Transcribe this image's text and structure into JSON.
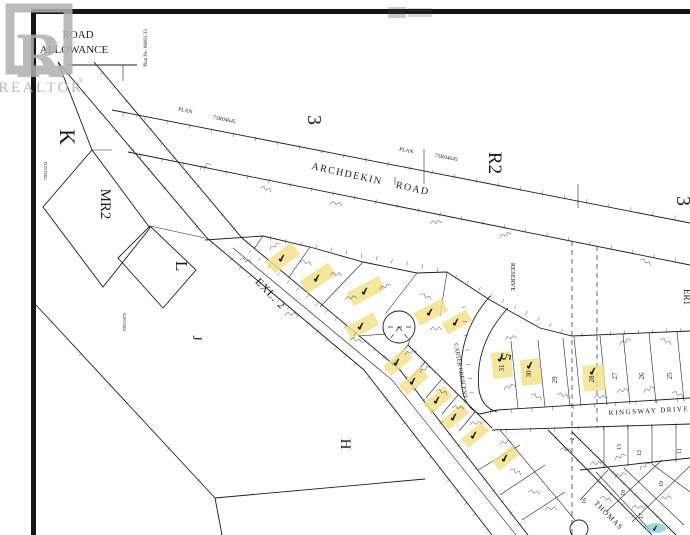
{
  "watermark": {
    "brand": "REALTOR",
    "registered": "®",
    "logo_letter": "R"
  },
  "colors": {
    "ink": "#1c1c1c",
    "highlight_yellow": "#f2e18a",
    "teal_marker": "#79cfcd",
    "watermark_gray": "#acacac",
    "paper": "#ffffff"
  },
  "annotations": {
    "mark_glyph": "✔",
    "marked_lot_count": 15,
    "teal_marked_count": 1
  },
  "labels": [
    {
      "id": "road-allowance-line1",
      "text": "ROAD",
      "x": 78,
      "y": 38,
      "rot": 0,
      "size": 11
    },
    {
      "id": "road-allowance-line2",
      "text": "ALLOWANCE",
      "x": 74,
      "y": 53,
      "rot": 0,
      "size": 11
    },
    {
      "id": "plan-number-vertical",
      "text": "Plan No. 86603 33",
      "x": 147,
      "y": 48,
      "rot": -90,
      "size": 5
    },
    {
      "id": "plan-label-1",
      "text": "PLAN",
      "x": 185,
      "y": 112,
      "rot": 12,
      "size": 5.5
    },
    {
      "id": "plan-number-1",
      "text": "75R04645",
      "x": 224,
      "y": 121,
      "rot": 12,
      "size": 5.5
    },
    {
      "id": "section-3-west",
      "text": "3",
      "x": 308,
      "y": 120,
      "rot": 90,
      "size": 20
    },
    {
      "id": "plan-label-2",
      "text": "PLAN",
      "x": 406,
      "y": 152,
      "rot": 11,
      "size": 5.5
    },
    {
      "id": "plan-number-2",
      "text": "75R04645",
      "x": 446,
      "y": 159,
      "rot": 11,
      "size": 5.5
    },
    {
      "id": "zone-r2",
      "text": "R2",
      "x": 489,
      "y": 163,
      "rot": 90,
      "size": 19
    },
    {
      "id": "section-3-east",
      "text": "3",
      "x": 677,
      "y": 201,
      "rot": 90,
      "size": 20
    },
    {
      "id": "archdekin-road",
      "text": "ARCHDEKIN ROAD",
      "x": 370,
      "y": 182,
      "rot": 12.5,
      "size": 10,
      "ls": 1.5,
      "ws": 10
    },
    {
      "id": "parcel-k",
      "text": "K",
      "x": 60,
      "y": 137,
      "rot": 90,
      "size": 22
    },
    {
      "id": "parcel-mr2",
      "text": "MR2",
      "x": 101,
      "y": 204,
      "rot": 90,
      "size": 15
    },
    {
      "id": "parcel-l",
      "text": "L",
      "x": 176,
      "y": 266,
      "rot": 90,
      "size": 17
    },
    {
      "id": "parcel-j",
      "text": "J",
      "x": 193,
      "y": 338,
      "rot": 90,
      "size": 13
    },
    {
      "id": "parcel-h",
      "text": "H",
      "x": 341,
      "y": 444,
      "rot": 90,
      "size": 15
    },
    {
      "id": "exl-2",
      "text": "EXL. 2",
      "x": 268,
      "y": 296,
      "rot": 46,
      "size": 11,
      "ls": 1
    },
    {
      "id": "reserve",
      "text": "RESERVE",
      "x": 511,
      "y": 277,
      "rot": 90,
      "size": 6.5
    },
    {
      "id": "carter-crescent",
      "text": "CARTER CRESCENT",
      "x": 459,
      "y": 371,
      "rot": 80,
      "size": 6
    },
    {
      "id": "parcel-5",
      "text": "5",
      "x": 501,
      "y": 356,
      "rot": 100,
      "size": 15
    },
    {
      "id": "kingsway-drive",
      "text": "KINGSWAY DRIVE",
      "x": 649,
      "y": 413,
      "rot": -3,
      "size": 7,
      "ls": 1.5
    },
    {
      "id": "thomas-street",
      "text": "THOMAS",
      "x": 607,
      "y": 517,
      "rot": 45,
      "size": 7.5,
      "ls": 1
    },
    {
      "id": "er1",
      "text": "ER1",
      "x": 684,
      "y": 297,
      "rot": 90,
      "size": 9
    },
    {
      "id": "plan-small-west",
      "text": "72B15234",
      "x": 47,
      "y": 171,
      "rot": -90,
      "size": 4.5
    },
    {
      "id": "plan-small-mid",
      "text": "92B15976",
      "x": 126,
      "y": 322,
      "rot": -90,
      "size": 4.5
    }
  ],
  "kingsway_lots": [
    {
      "number": "31",
      "x": 504,
      "y": 368,
      "highlighted": true
    },
    {
      "number": "30",
      "x": 531,
      "y": 374,
      "highlighted": true
    },
    {
      "number": "29",
      "x": 557,
      "y": 380,
      "highlighted": false
    },
    {
      "number": "28",
      "x": 594,
      "y": 379,
      "highlighted": true
    },
    {
      "number": "27",
      "x": 617,
      "y": 376,
      "highlighted": false
    },
    {
      "number": "26",
      "x": 644,
      "y": 376,
      "highlighted": false
    },
    {
      "number": "25",
      "x": 672,
      "y": 376,
      "highlighted": false
    }
  ],
  "se_lots": [
    {
      "number": "2",
      "x": 574,
      "y": 439
    },
    {
      "number": "13",
      "x": 621,
      "y": 447
    },
    {
      "number": "12",
      "x": 641,
      "y": 453
    },
    {
      "number": "11",
      "x": 681,
      "y": 451
    },
    {
      "number": "16",
      "x": 586,
      "y": 501
    },
    {
      "number": "19",
      "x": 663,
      "y": 484
    },
    {
      "number": "18",
      "x": 625,
      "y": 493
    },
    {
      "number": "17",
      "x": 643,
      "y": 516
    }
  ],
  "highlights": [
    {
      "cx": 283,
      "cy": 258,
      "w": 32,
      "h": 15,
      "rot": -38
    },
    {
      "cx": 318,
      "cy": 278,
      "w": 34,
      "h": 15,
      "rot": -33
    },
    {
      "cx": 366,
      "cy": 291,
      "w": 36,
      "h": 15,
      "rot": -28
    },
    {
      "cx": 362,
      "cy": 326,
      "w": 32,
      "h": 14,
      "rot": -28
    },
    {
      "cx": 431,
      "cy": 312,
      "w": 32,
      "h": 14,
      "rot": -28
    },
    {
      "cx": 457,
      "cy": 322,
      "w": 28,
      "h": 13,
      "rot": -30
    },
    {
      "cx": 398,
      "cy": 362,
      "w": 28,
      "h": 13,
      "rot": -40
    },
    {
      "cx": 414,
      "cy": 381,
      "w": 28,
      "h": 13,
      "rot": -40
    },
    {
      "cx": 438,
      "cy": 400,
      "w": 28,
      "h": 13,
      "rot": -40
    },
    {
      "cx": 455,
      "cy": 417,
      "w": 27,
      "h": 12,
      "rot": -40
    },
    {
      "cx": 475,
      "cy": 435,
      "w": 27,
      "h": 12,
      "rot": -40
    },
    {
      "cx": 502,
      "cy": 365,
      "w": 20,
      "h": 26,
      "rot": -6,
      "mdy": -7
    },
    {
      "cx": 531,
      "cy": 372,
      "w": 20,
      "h": 26,
      "rot": -6,
      "mdy": -7
    },
    {
      "cx": 594,
      "cy": 378,
      "w": 22,
      "h": 26,
      "rot": -4,
      "mdy": -7
    },
    {
      "cx": 506,
      "cy": 458,
      "w": 26,
      "h": 12,
      "rot": -40
    }
  ],
  "teal_marker": {
    "cx": 656,
    "cy": 528,
    "rx": 10,
    "ry": 5
  }
}
